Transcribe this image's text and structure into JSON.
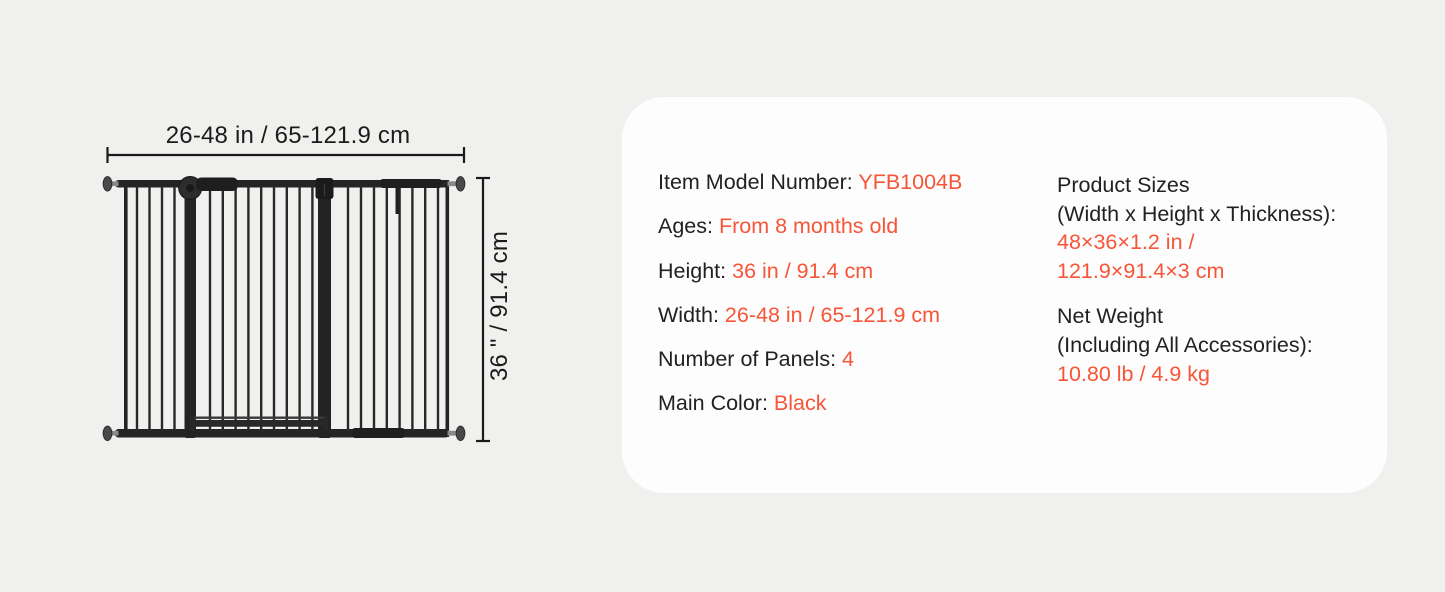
{
  "page": {
    "background_color": "#f0f0ee"
  },
  "diagram": {
    "width_label": "26-48 in / 65-121.9 cm",
    "height_label": "36 \" / 91.4 cm",
    "gate_color": "#242424"
  },
  "spec_card": {
    "background_color": "#fdfdfd",
    "text_color": "#212121",
    "accent_color": "#f85437",
    "left_column": [
      {
        "label": "Item Model Number: ",
        "value": "YFB1004B"
      },
      {
        "label": "Ages: ",
        "value": "From 8 months old"
      },
      {
        "label": "Height: ",
        "value": "36 in / 91.4 cm"
      },
      {
        "label": "Width: ",
        "value": "26-48 in / 65-121.9 cm"
      },
      {
        "label": "Number of Panels: ",
        "value": "4"
      },
      {
        "label": "Main Color: ",
        "value": "Black"
      }
    ],
    "right_column": [
      {
        "label_lines": [
          "Product Sizes",
          "(Width x Height x Thickness):"
        ],
        "value_lines": [
          "48×36×1.2 in /",
          "121.9×91.4×3 cm"
        ]
      },
      {
        "label_lines": [
          "Net Weight",
          "(Including All Accessories):"
        ],
        "value_lines": [
          "10.80 lb / 4.9 kg"
        ]
      }
    ]
  }
}
